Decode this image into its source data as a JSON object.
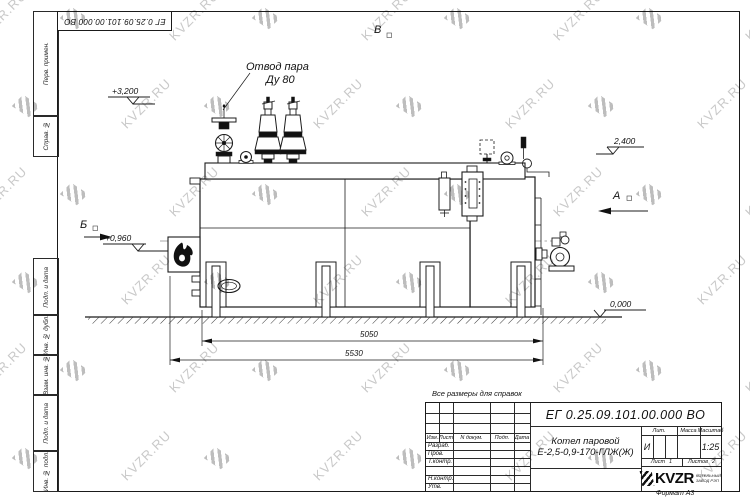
{
  "page": {
    "watermark_text": "KVZR.RU",
    "format_label": "Формат А3",
    "note": "Все размеры для справок"
  },
  "corner_stamp": {
    "designation": "ЕГ 0.25.09.101.00.000  ВО"
  },
  "margin": {
    "items": [
      {
        "label": "Перв. примен."
      },
      {
        "label": "Справ. №"
      },
      {
        "label": "Подп. и дата"
      },
      {
        "label": "Инв. № дубл."
      },
      {
        "label": "Взам. инв. №"
      },
      {
        "label": "Подп. и дата"
      },
      {
        "label": "Инв. № подл."
      }
    ]
  },
  "drawing": {
    "steam_outlet_label_line1": "Отвод пара",
    "steam_outlet_label_line2": "Ду 80",
    "view_top": "В",
    "view_left": "Б",
    "view_right": "А",
    "elev_top_left": "+3,200",
    "elev_burner": "+0,960",
    "elev_right": "2,400",
    "elev_ground": "0,000",
    "dim_inner": "5050",
    "dim_outer": "5530"
  },
  "title_block": {
    "designation": "ЕГ 0.25.09.101.00.000  ВО",
    "product_line1": "Котел паровой",
    "product_line2": "Е-2,5-0,9-170-ГЛЖ(Ж)",
    "cols": {
      "izm": "Изм.",
      "list": "Лист",
      "ndokum": "N докум.",
      "podp": "Подп.",
      "data": "Дата"
    },
    "rows": [
      "Разраб.",
      "Пров.",
      "Т.контр.",
      "",
      "Н.контр.",
      "Утв."
    ],
    "lit_label": "Лит.",
    "lit_value": "И",
    "mass_label": "Масса",
    "scale_label": "Масштаб",
    "scale_value": "1:25",
    "sheet_label": "Лист",
    "sheet_value": "1",
    "sheets_label": "Листов",
    "sheets_value": "2",
    "logo_text": "KVZR",
    "logo_caption_line1": "КОТЕЛЬНЫЙ",
    "logo_caption_line2": "ЗАВОД РЭП"
  }
}
